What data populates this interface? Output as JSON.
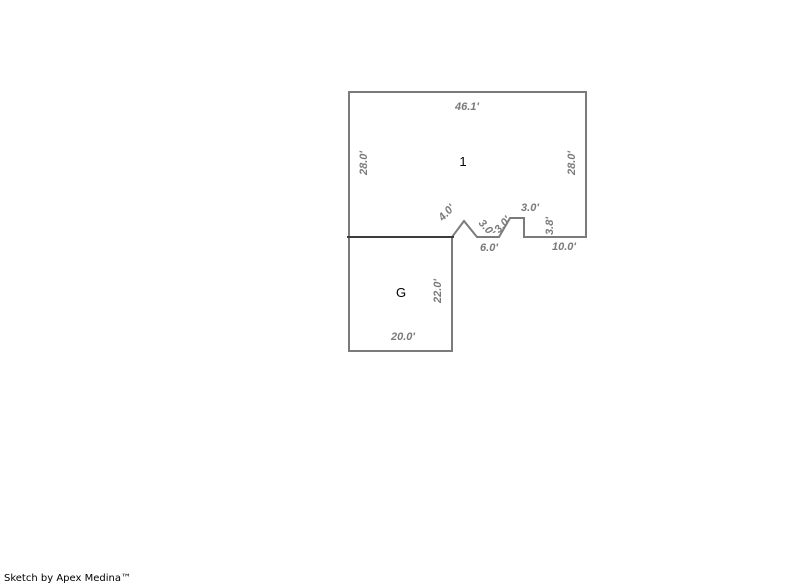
{
  "footer": {
    "credit": "Sketch by Apex Medina™"
  },
  "sketch": {
    "colors": {
      "wall_gray": "#7b7b7b",
      "shared_wall_dark": "#3c3c3c",
      "dim_text": "#7a7a7a",
      "room_text": "#000000",
      "background": "#ffffff"
    },
    "area1": {
      "label": "1",
      "width_top": "46.1'",
      "height_left": "28.0'",
      "height_right": "28.0'"
    },
    "notch": {
      "diag_4": "4.0'",
      "diag_3_left": "3.0'",
      "base_6": "6.0'",
      "diag_3_right": "3.0'",
      "bump_top_3": "3.0'",
      "bump_side_3_8": "3.8'",
      "base_10": "10.0'"
    },
    "garage": {
      "label": "G",
      "height_right": "22.0'",
      "width_bottom": "20.0'"
    }
  }
}
